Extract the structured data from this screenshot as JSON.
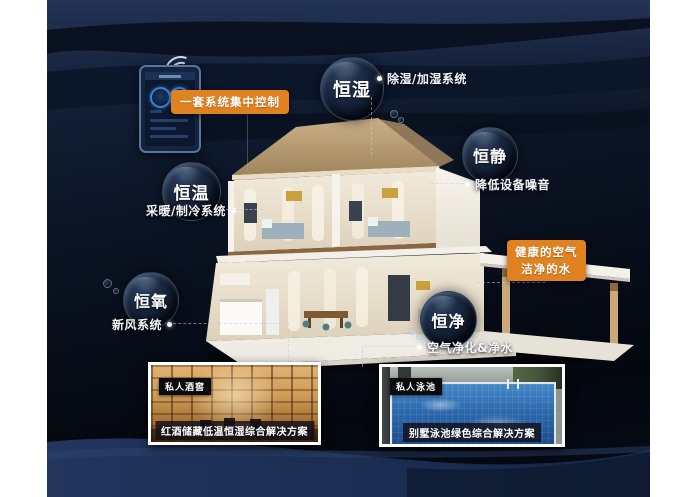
{
  "colors": {
    "accent_orange": "#E08220",
    "background_navy": "#0C1526",
    "bottom_wave_blue": "#20345B",
    "text_white": "#FFFFFF"
  },
  "control_panel": {
    "badge_label": "一套系统集中控制"
  },
  "features": [
    {
      "label": "恒湿",
      "note": "除湿/加湿系统"
    },
    {
      "label": "恒静",
      "note": "降低设备噪音"
    },
    {
      "label": "恒温",
      "note": "采暖/制冷系统"
    },
    {
      "label": "恒氧",
      "note": "新风系统"
    },
    {
      "label": "恒净",
      "note": "空气净化&净水"
    }
  ],
  "highlight_badge": {
    "line1": "健康的空气",
    "line2": "洁净的水"
  },
  "solutions": [
    {
      "tag": "私人酒窖",
      "caption": "红酒储藏低温恒湿综合解决方案"
    },
    {
      "tag": "私人泳池",
      "caption": "别墅泳池绿色综合解决方案"
    }
  ]
}
